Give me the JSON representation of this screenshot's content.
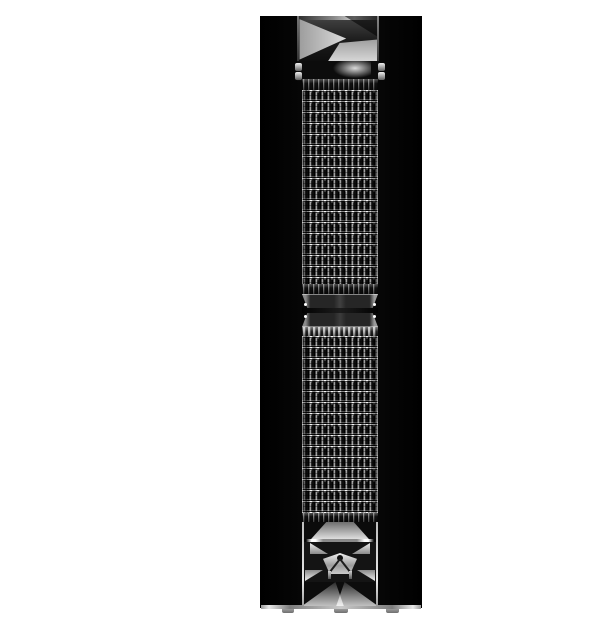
{
  "image": {
    "alt": "Product photo of a dark polished stainless steel mesh watch band displayed upright on a glossy black pillar stand against a white background",
    "subject": "metal mesh watch band with lug adapter and deployment clasp"
  },
  "scene": {
    "parts": {
      "backdrop": "white studio backdrop",
      "stand": "black display pillar with base and feet",
      "lug": "watch lug adapter",
      "connector": "spring-bar connector",
      "mesh_upper": "upper woven mesh segment",
      "junction": "mid-band end bars",
      "mesh_lower": "lower woven mesh segment",
      "clasp": "deployment clasp with release emblem"
    }
  },
  "colors": {
    "backdrop": "#ffffff",
    "stand": "#050505",
    "metal-dark": "#1a1a1a",
    "metal-mid": "#555555",
    "metal-light": "#d9d9d9",
    "sparkle": "#ffffff"
  }
}
